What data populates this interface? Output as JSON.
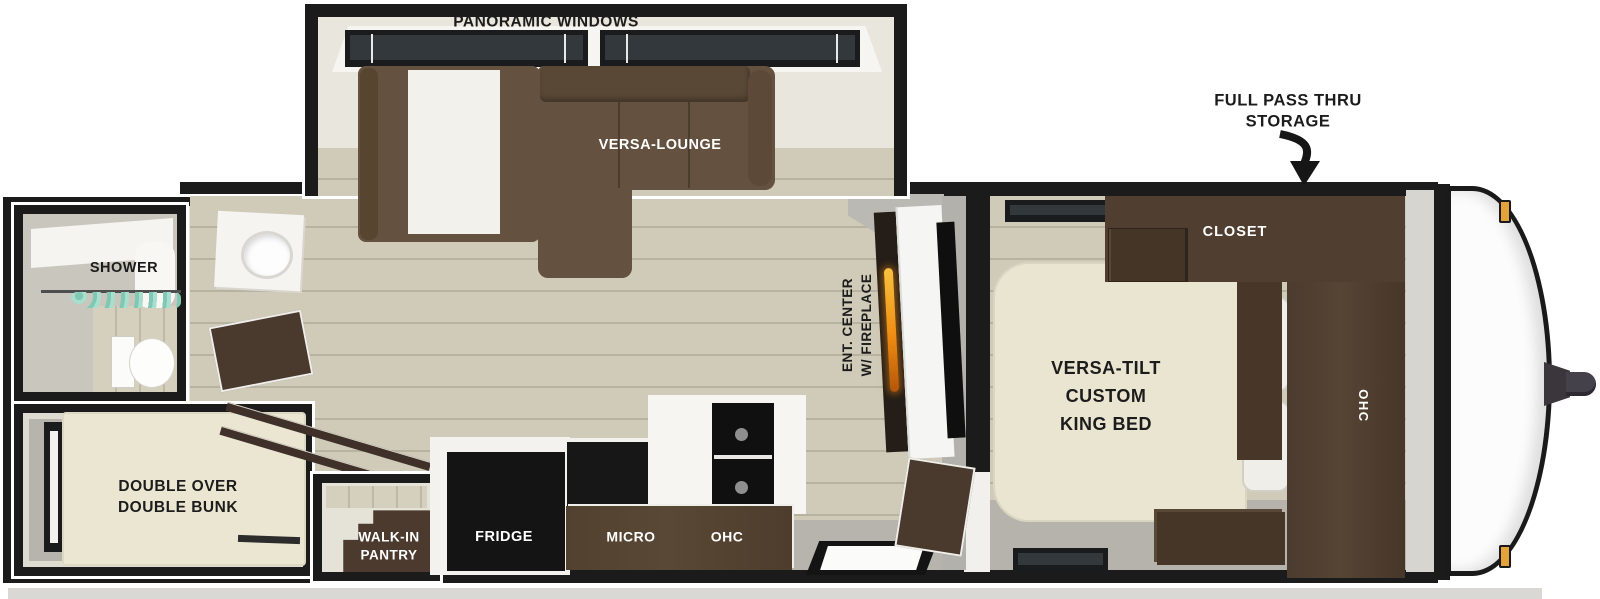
{
  "figure": "travel-trailer-floorplan",
  "labels": {
    "slideout": {
      "windows": "PANORAMIC WINDOWS",
      "lounge": "VERSA-LOUNGE"
    },
    "callout": {
      "storage": "FULL PASS THRU\nSTORAGE"
    },
    "bedroom": {
      "closet": "CLOSET",
      "bed": "VERSA-TILT\nCUSTOM\nKING BED",
      "ohc": "OHC"
    },
    "living": {
      "ent_center": "ENT. CENTER\nW/ FIREPLACE"
    },
    "bathroom": {
      "shower": "SHOWER"
    },
    "bunk_room": {
      "bunk": "DOUBLE OVER\nDOUBLE BUNK"
    },
    "kitchen": {
      "fridge": "FRIDGE",
      "micro": "MICRO",
      "ohc": "OHC",
      "pantry": "WALK-IN\nPANTRY"
    }
  },
  "icons": {
    "storage_arrow": "curved-down-arrow",
    "fireplace_flame": "flame"
  },
  "colors": {
    "wall_black": "#1b1b1b",
    "interior_cream": "#e8e5da",
    "floor_wood": "#cfcbb8",
    "floor_gray": "#b6b4ad",
    "sofa_brown": "#64513f",
    "cabinet_brown": "#4c3b2e",
    "mattress_cream": "#eae6d2",
    "appliance_black": "#151515",
    "curtain_teal": "#7fc9b4",
    "flame_orange": "#ef8c12",
    "marker_light": "#e3a23c"
  }
}
